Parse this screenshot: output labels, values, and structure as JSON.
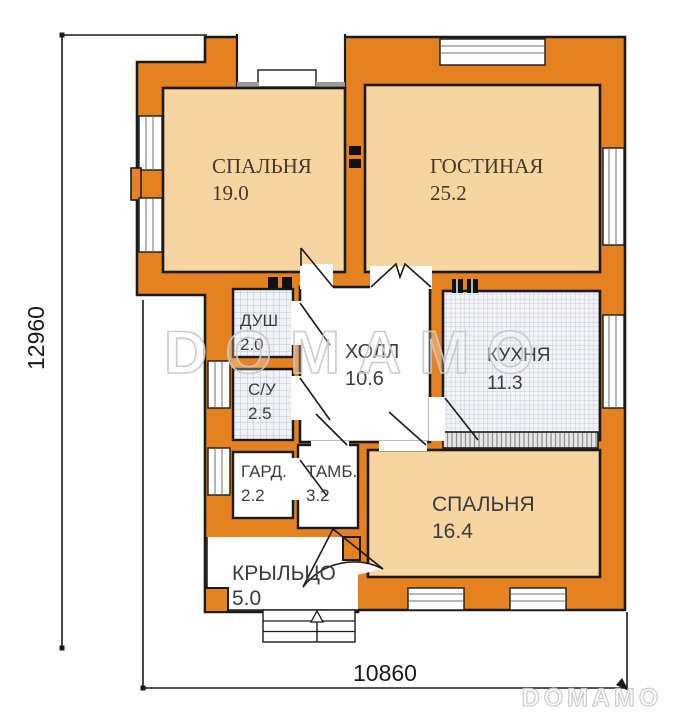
{
  "plan": {
    "rooms": [
      {
        "id": "bedroom-1",
        "name": "СПАЛЬНЯ",
        "area": "19.0"
      },
      {
        "id": "living-room",
        "name": "ГОСТИНАЯ",
        "area": "25.2"
      },
      {
        "id": "shower",
        "name": "ДУШ",
        "area": "2.0"
      },
      {
        "id": "hall",
        "name": "ХОЛЛ",
        "area": "10.6"
      },
      {
        "id": "kitchen",
        "name": "КУХНЯ",
        "area": "11.3"
      },
      {
        "id": "bathroom",
        "name": "С/У",
        "area": "2.5"
      },
      {
        "id": "wardrobe",
        "name": "ГАРД.",
        "area": "2.2"
      },
      {
        "id": "vestibule",
        "name": "ТАМБ.",
        "area": "3.2"
      },
      {
        "id": "bedroom-2",
        "name": "СПАЛЬНЯ",
        "area": "16.4"
      },
      {
        "id": "porch",
        "name": "КРЫЛЬЦО",
        "area": "5.0"
      }
    ],
    "dimensions": {
      "height_label": "12960",
      "width_label": "10860"
    },
    "watermark": {
      "text": "DOMAMO"
    },
    "colors": {
      "wall": "#e5821f",
      "room_floor": "#f6d5a0",
      "tile_floor": "#f1f2f8",
      "tile_line": "#bcc3d8",
      "outline": "#1a1a1a",
      "window_gray": "#8f8f8f",
      "watermark_gray": "#c8c8c8"
    }
  }
}
